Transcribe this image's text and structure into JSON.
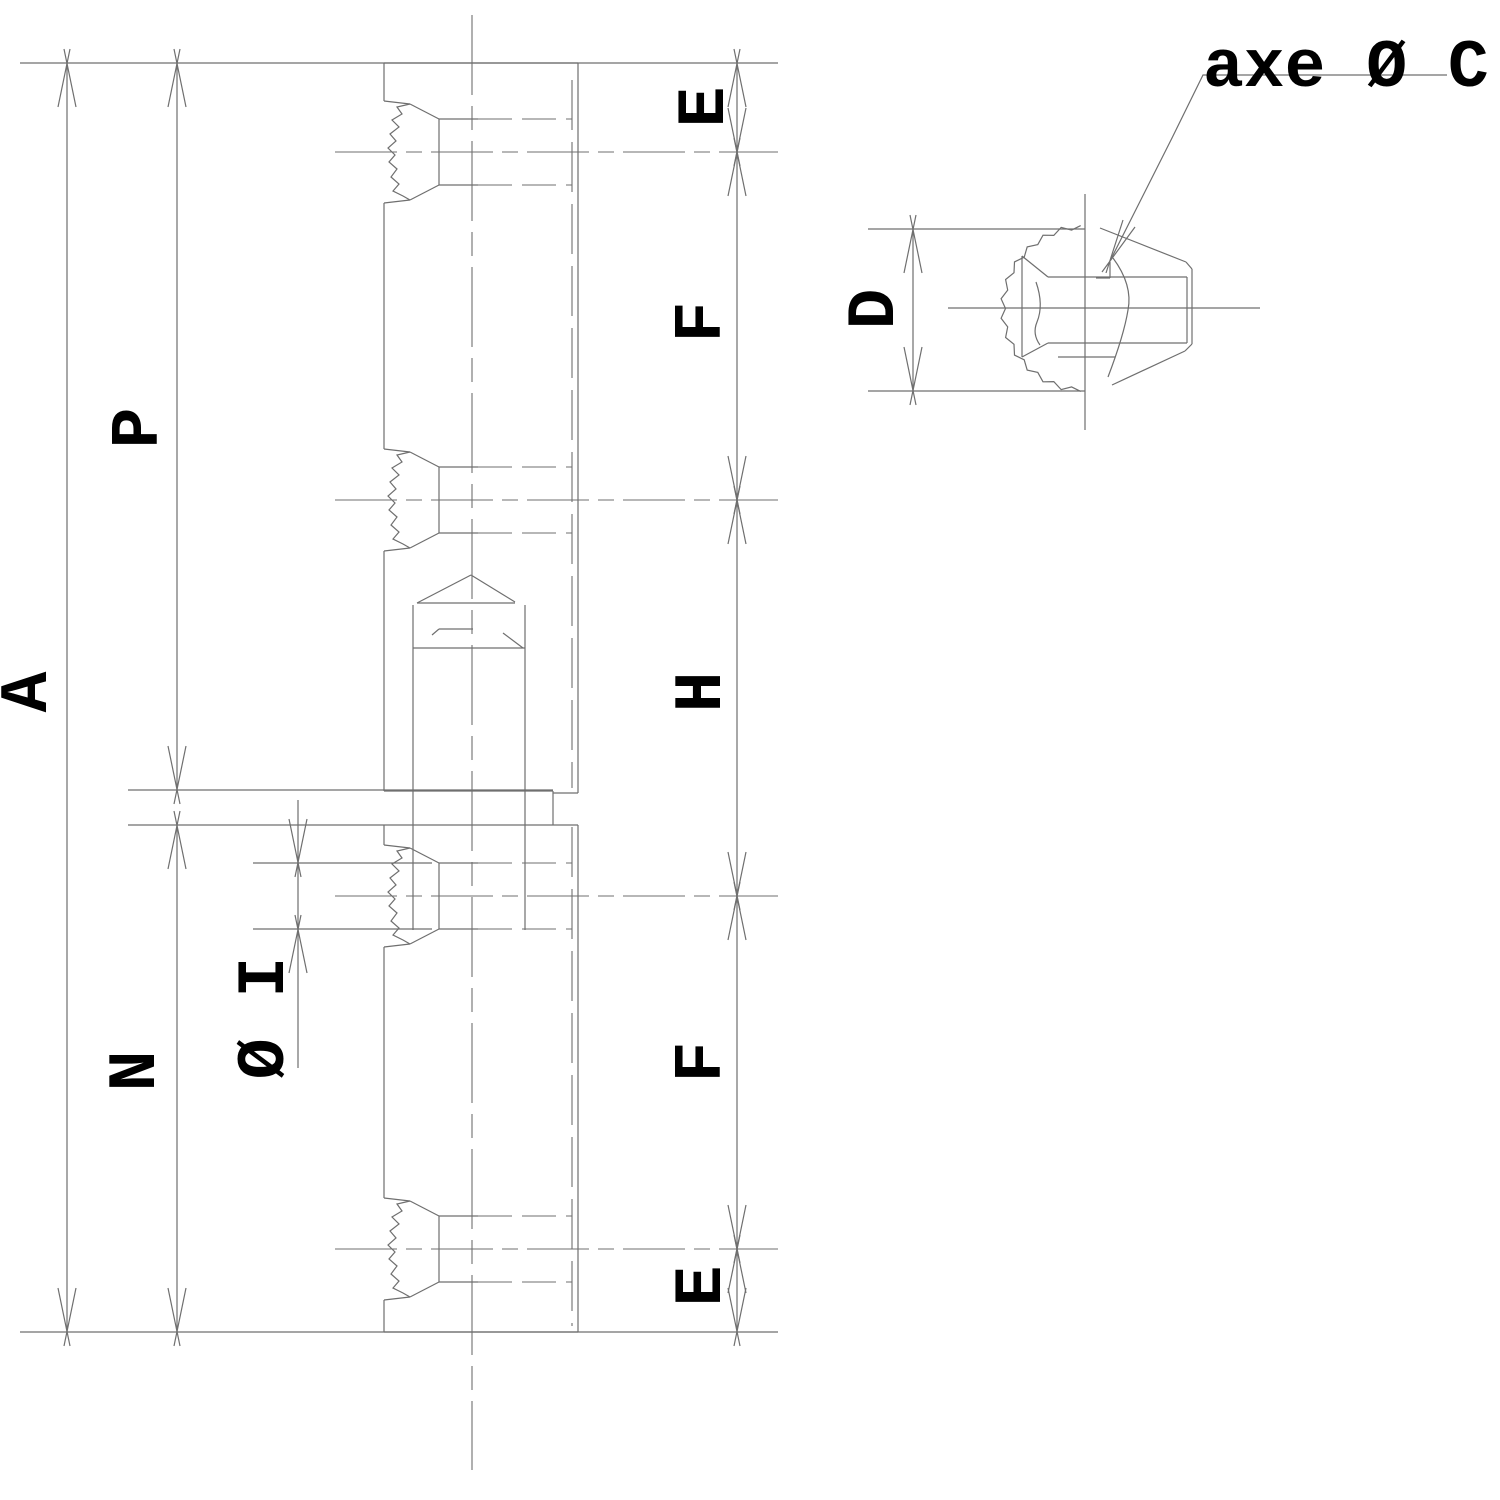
{
  "drawing": {
    "type": "technical-drawing",
    "views": {
      "side_section": "hinge barrel side section with four welded knuckle joints and internal pin",
      "top": "hinge knuckle top view with torch-cut edge"
    },
    "labels": {
      "a": "A",
      "p": "P",
      "n": "N",
      "i": "Ø I",
      "d": "D",
      "e_top": "E",
      "f_top": "F",
      "h": "H",
      "f_bottom": "F",
      "e_bottom": "E",
      "axis": "axe Ø C"
    },
    "colors": {
      "line": "#6f6f6f",
      "text": "#000000",
      "background": "#ffffff"
    }
  }
}
